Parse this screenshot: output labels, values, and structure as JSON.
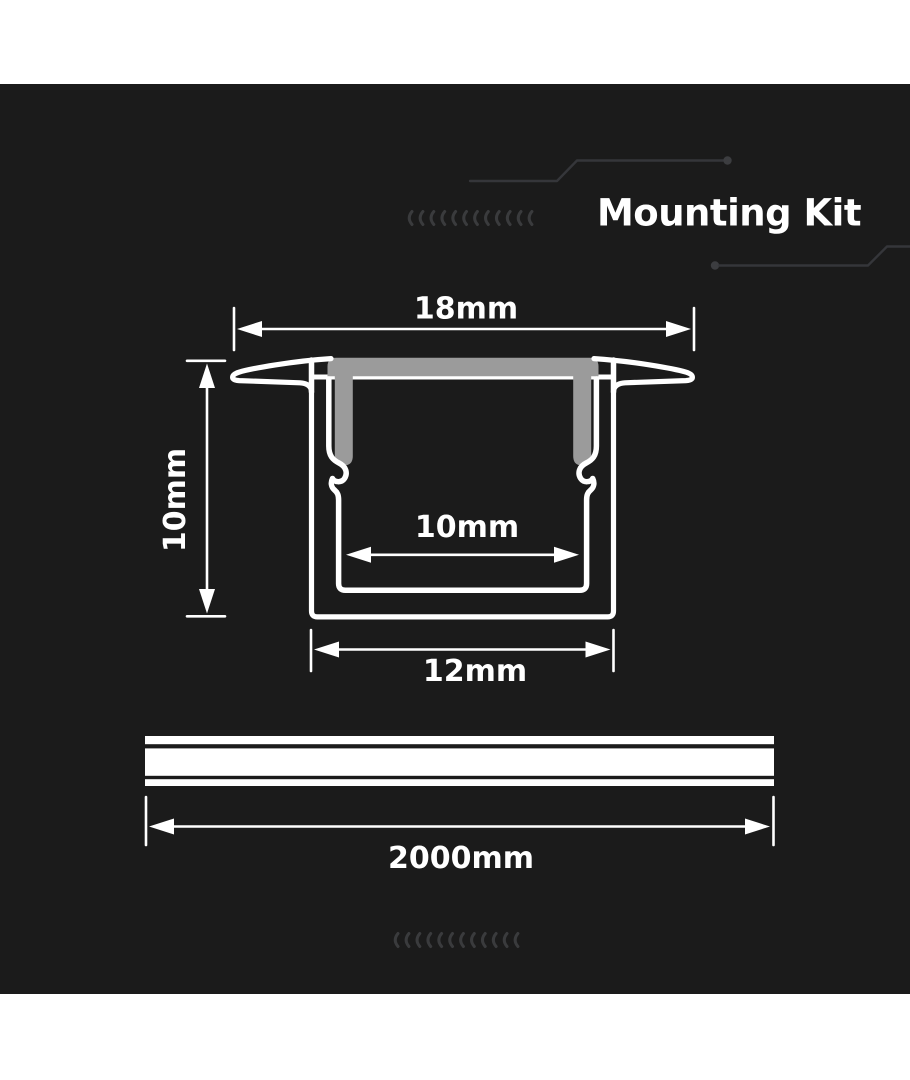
{
  "page": {
    "background": "#ffffff"
  },
  "panel": {
    "background": "#1b1b1b"
  },
  "header": {
    "title": "Mounting Kit",
    "title_color": "#ffffff"
  },
  "diagram": {
    "cross_section": {
      "dim_top_width": "18mm",
      "dim_height": "10mm",
      "dim_inner_width": "10mm",
      "dim_bottom_width": "12mm",
      "outline_color": "#ffffff",
      "diffuser_color": "#9b9b9b"
    },
    "length_profile": {
      "dim_length": "2000mm",
      "bar_color": "#ffffff"
    }
  },
  "decorations": {
    "chevron_count": 12,
    "chevron_color": "#3a3b3d",
    "circuit_color": "#35363a"
  }
}
